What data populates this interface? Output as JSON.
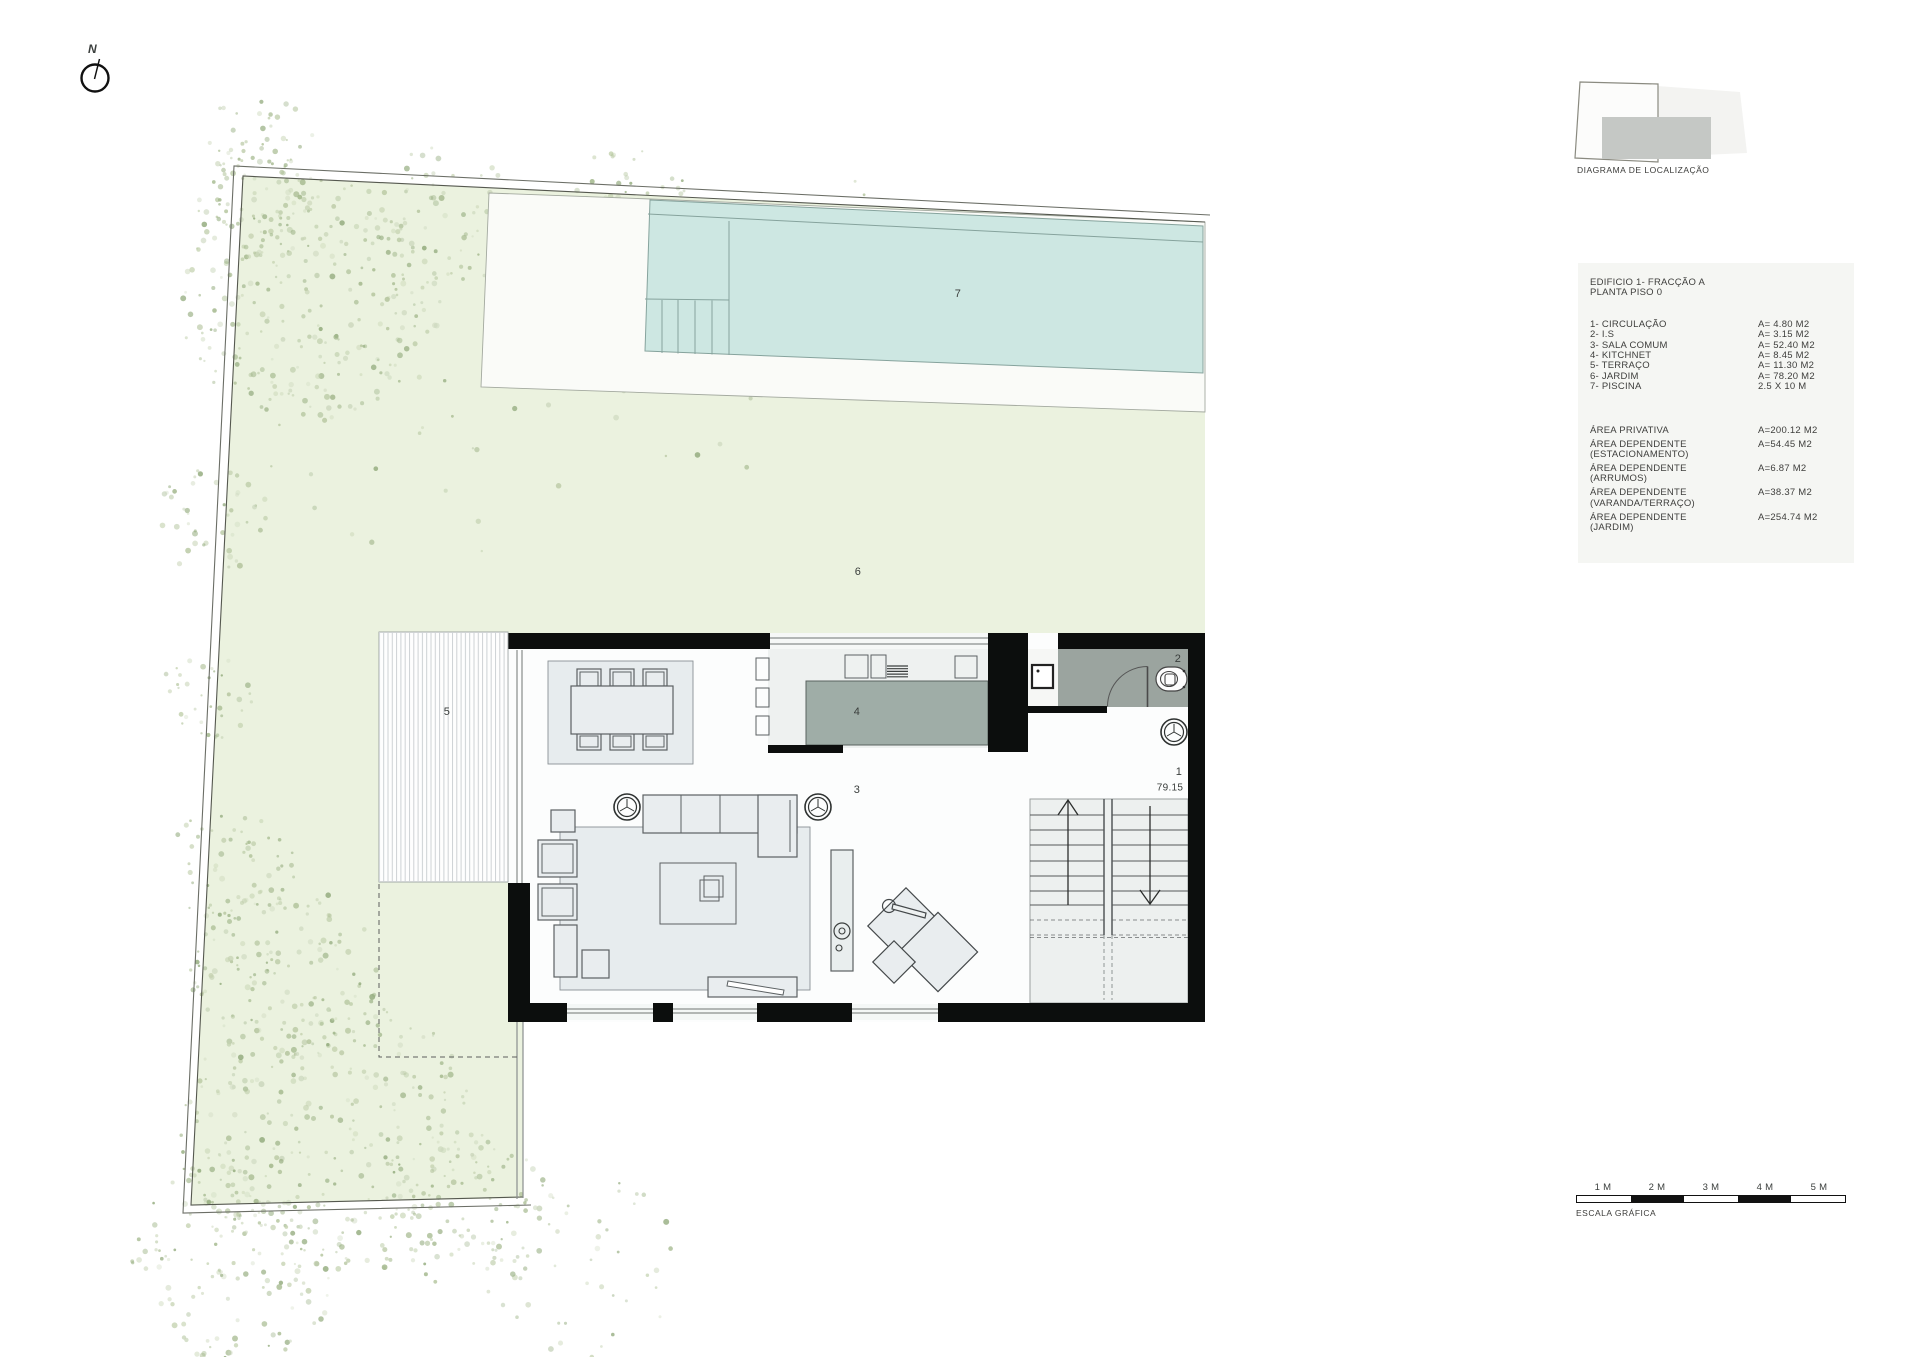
{
  "north": {
    "label": "N"
  },
  "location_diagram": {
    "caption": "DIAGRAMA DE LOCALIZAÇÃO"
  },
  "legend": {
    "title_line1": "EDIFICIO 1- FRACÇÃO A",
    "title_line2": "PLANTA PISO 0",
    "items": [
      {
        "label": "1- CIRCULAÇÃO",
        "value": "A= 4.80 M2"
      },
      {
        "label": "2- I.S",
        "value": "A= 3.15 M2"
      },
      {
        "label": "3- SALA COMUM",
        "value": "A= 52.40 M2"
      },
      {
        "label": "4- KITCHNET",
        "value": "A= 8.45 M2"
      },
      {
        "label": "5- TERRAÇO",
        "value": "A= 11.30 M2"
      },
      {
        "label": "6- JARDIM",
        "value": "A= 78.20 M2"
      },
      {
        "label": "7- PISCINA",
        "value": "2.5 X 10 M"
      }
    ],
    "areas": [
      {
        "label": "ÁREA PRIVATIVA",
        "label2": "",
        "value": "A=200.12 M2"
      },
      {
        "label": "ÁREA DEPENDENTE",
        "label2": "(ESTACIONAMENTO)",
        "value": "A=54.45 M2"
      },
      {
        "label": "ÁREA DEPENDENTE",
        "label2": "(ARRUMOS)",
        "value": "A=6.87 M2"
      },
      {
        "label": "ÁREA DEPENDENTE",
        "label2": "(VARANDA/TERRAÇO)",
        "value": "A=38.37 M2"
      },
      {
        "label": "ÁREA DEPENDENTE",
        "label2": "(JARDIM)",
        "value": "A=254.74 M2"
      }
    ]
  },
  "plan": {
    "labels": {
      "circulation": "1",
      "bathroom": "2",
      "living": "3",
      "kitchen": "4",
      "terrace": "5",
      "garden": "6",
      "pool": "7"
    },
    "level": "79.15"
  },
  "scalebar": {
    "labels": [
      "1 M",
      "2 M",
      "3 M",
      "4 M",
      "5 M"
    ],
    "caption": "ESCALA GRÁFICA"
  },
  "colors": {
    "garden_green": "#ebf2df",
    "pool_teal": "#cde7e2",
    "wall_black": "#0c0e0d",
    "bathroom_gray": "#9ba49f",
    "island_gray": "#9fada7",
    "panel_gray": "#f5f6f3"
  }
}
